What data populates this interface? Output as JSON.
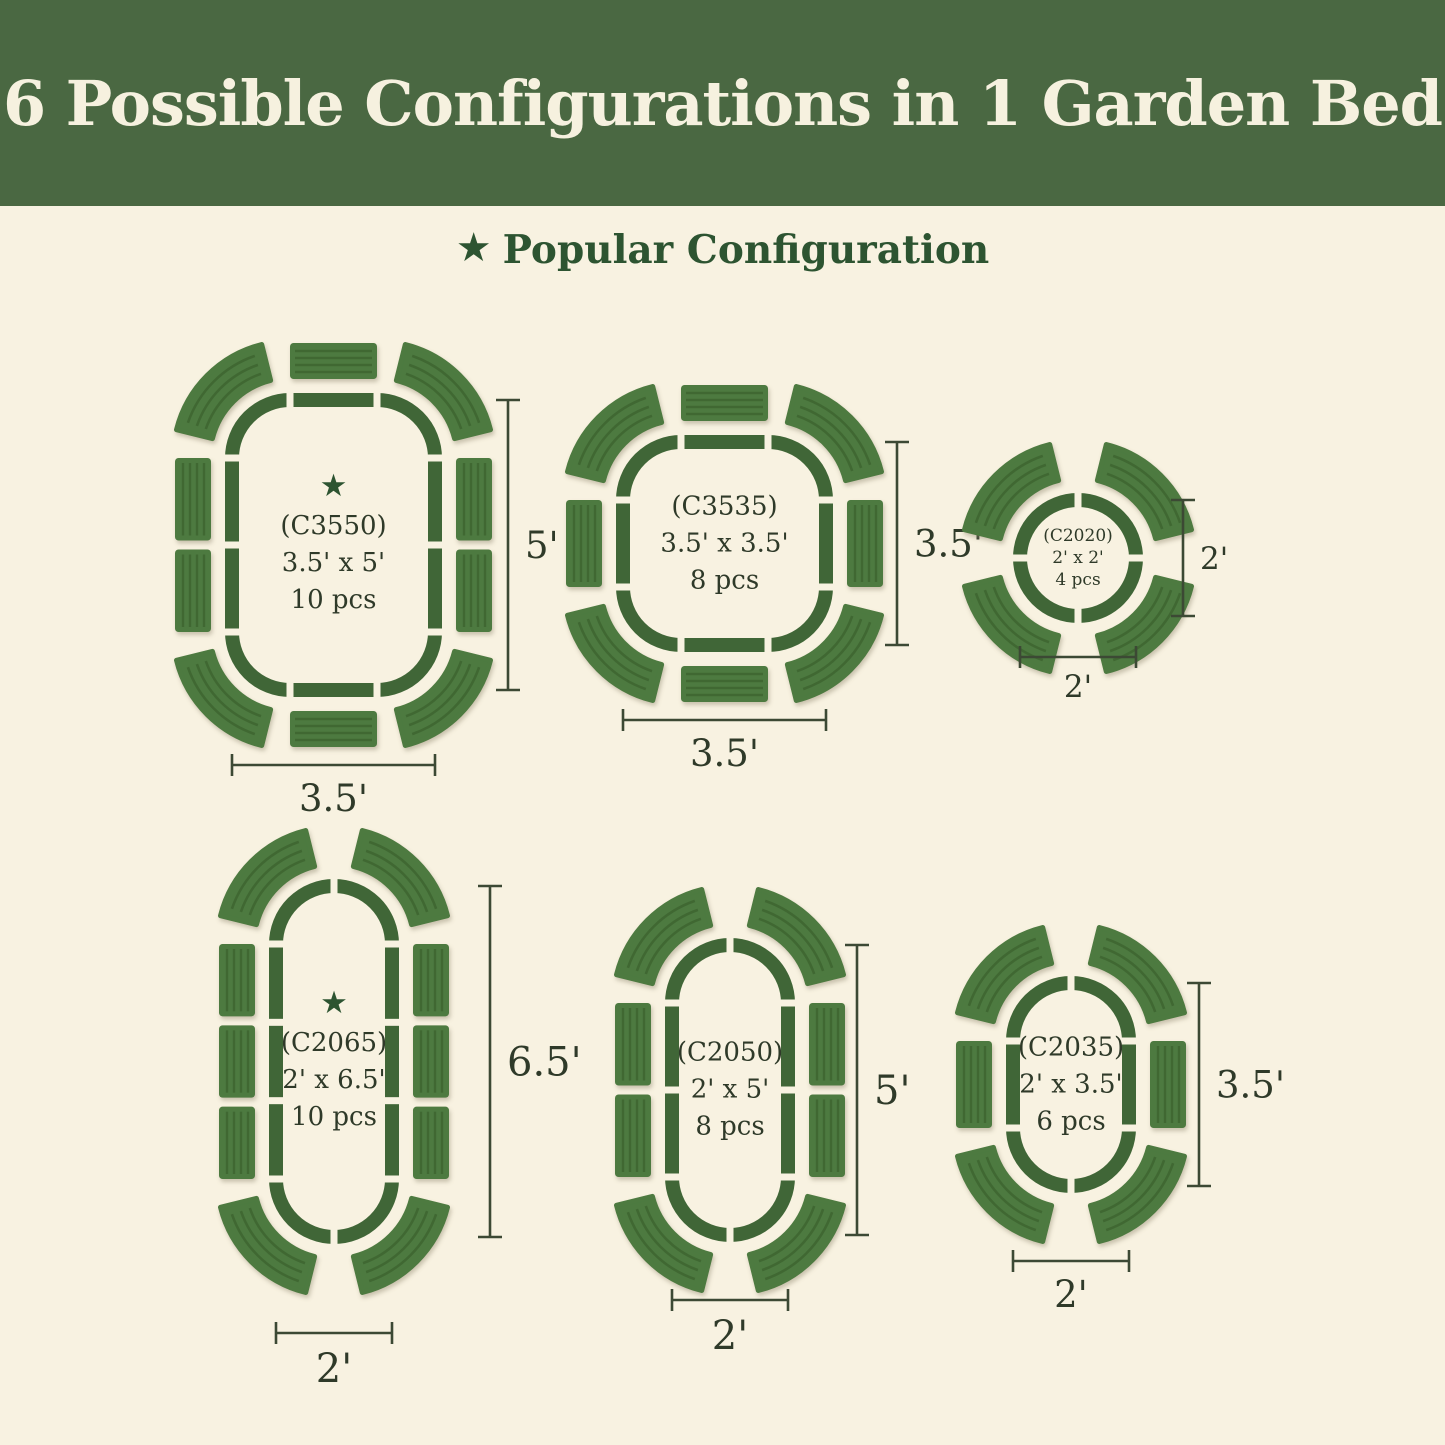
{
  "title": "6 Possible Configurations in 1 Garden Bed",
  "legend": {
    "star_icon": "★",
    "star_label": "Popular Configuration"
  },
  "colors": {
    "page_bg": "#f8f2e1",
    "banner_bg": "#4a6842",
    "banner_text": "#f6f1df",
    "outline_green": "#406637",
    "panel_green": "#4d7a40",
    "panel_stripe": "#3e6632",
    "star_green": "#2d5431",
    "subtitle_green": "#2d5431",
    "label_text": "#2f3a29",
    "dim_color": "#3c4934"
  },
  "configs": [
    {
      "id": "c3550",
      "code": "(C3550)",
      "size": "3.5' x 5'",
      "pieces": "10 pcs",
      "starred": true,
      "width_ft": 3.5,
      "height_ft": 5,
      "width_label": "3.5'",
      "height_label": "5'",
      "panels": {
        "corners": 4,
        "left": 2,
        "right": 2,
        "top": 1,
        "bottom": 1
      }
    },
    {
      "id": "c3535",
      "code": "(C3535)",
      "size": "3.5' x 3.5'",
      "pieces": "8 pcs",
      "starred": false,
      "width_ft": 3.5,
      "height_ft": 3.5,
      "width_label": "3.5'",
      "height_label": "3.5'",
      "panels": {
        "corners": 4,
        "left": 1,
        "right": 1,
        "top": 1,
        "bottom": 1
      }
    },
    {
      "id": "c2020",
      "code": "(C2020)",
      "size": "2' x 2'",
      "pieces": "4 pcs",
      "starred": false,
      "width_ft": 2,
      "height_ft": 2,
      "width_label": "2'",
      "height_label": "2'",
      "panels": {
        "corners": 4,
        "left": 0,
        "right": 0,
        "top": 0,
        "bottom": 0
      }
    },
    {
      "id": "c2065",
      "code": "(C2065)",
      "size": "2' x 6.5'",
      "pieces": "10 pcs",
      "starred": true,
      "width_ft": 2,
      "height_ft": 6.5,
      "width_label": "2'",
      "height_label": "6.5'",
      "panels": {
        "corners": 4,
        "left": 3,
        "right": 3,
        "top": 0,
        "bottom": 0
      }
    },
    {
      "id": "c2050",
      "code": "(C2050)",
      "size": "2' x 5'",
      "pieces": "8 pcs",
      "starred": false,
      "width_ft": 2,
      "height_ft": 5,
      "width_label": "2'",
      "height_label": "5'",
      "panels": {
        "corners": 4,
        "left": 2,
        "right": 2,
        "top": 0,
        "bottom": 0
      }
    },
    {
      "id": "c2035",
      "code": "(C2035)",
      "size": "2' x 3.5'",
      "pieces": "6 pcs",
      "starred": false,
      "width_ft": 2,
      "height_ft": 3.5,
      "width_label": "2'",
      "height_label": "3.5'",
      "panels": {
        "corners": 4,
        "left": 1,
        "right": 1,
        "top": 0,
        "bottom": 0
      }
    }
  ]
}
